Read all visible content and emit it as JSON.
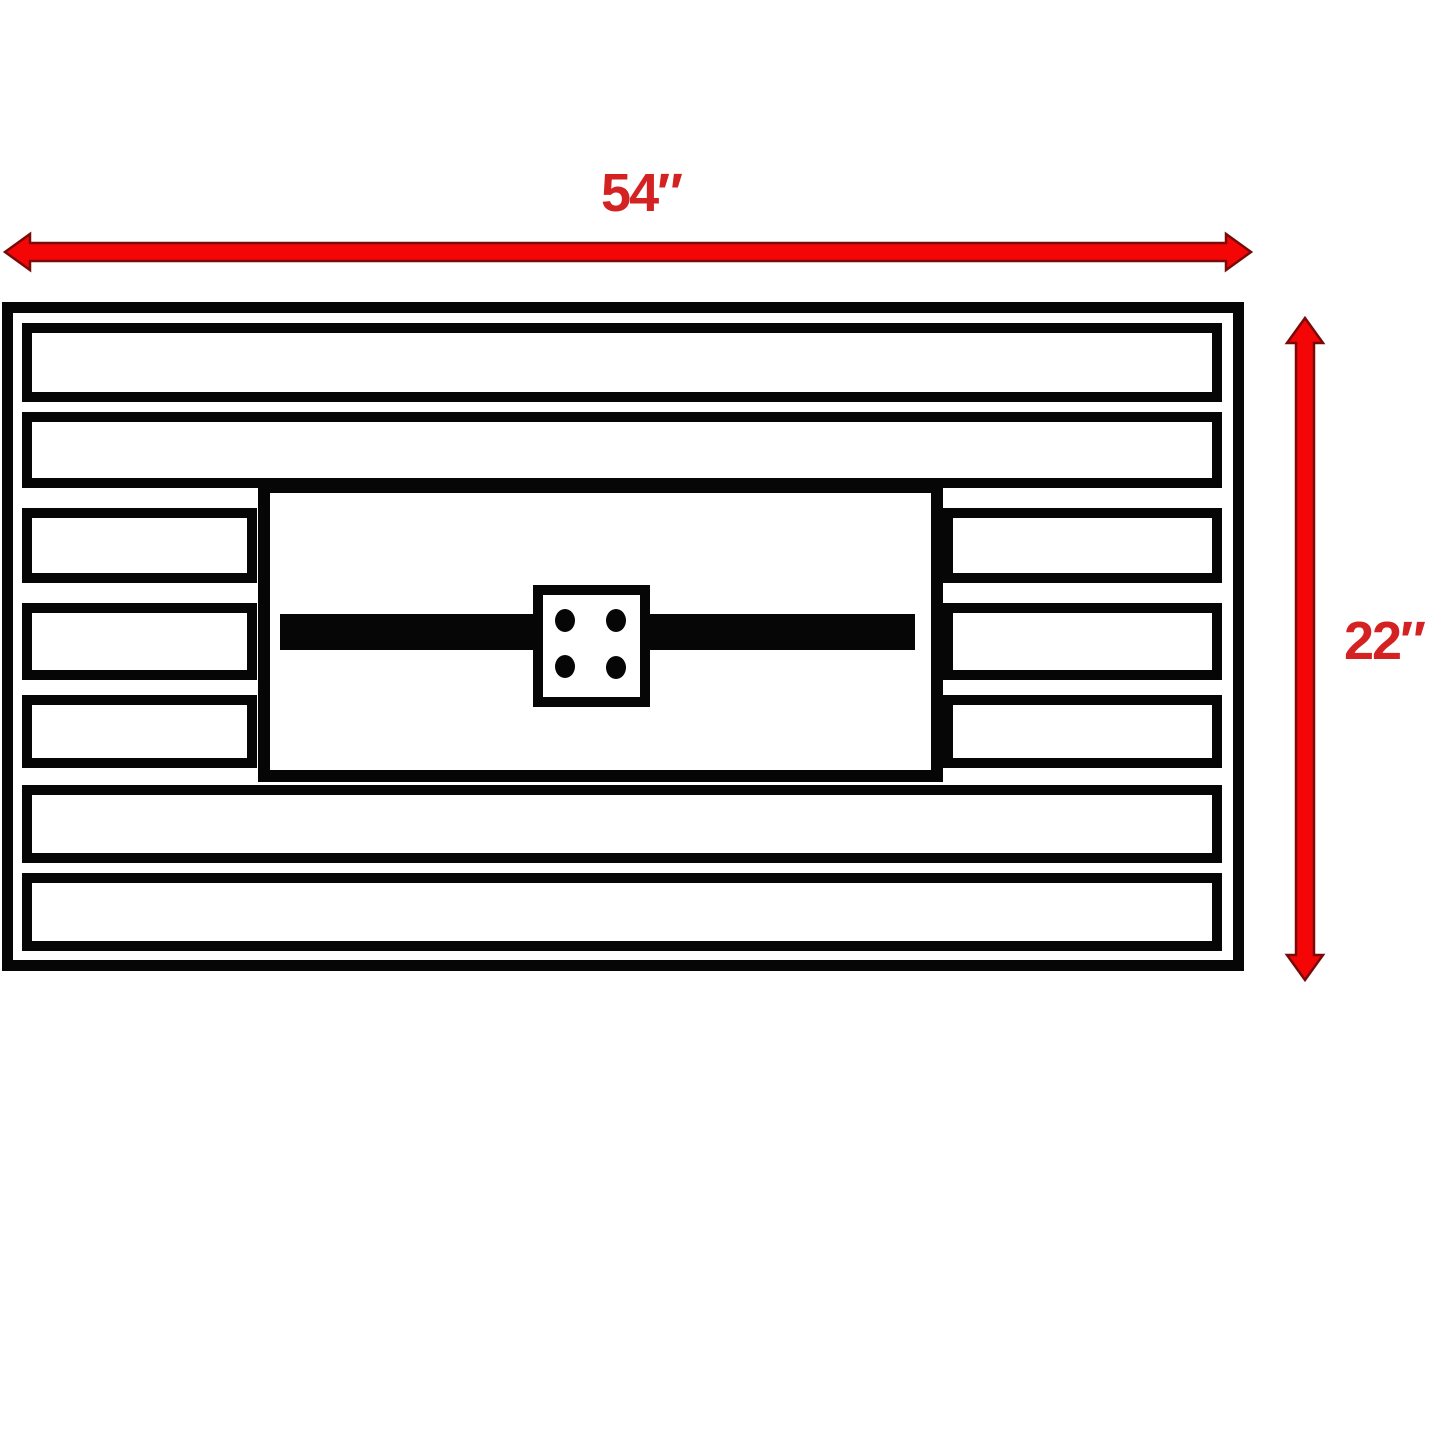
{
  "labels": {
    "width": "54″",
    "height": "22″"
  },
  "colors": {
    "background": "#ffffff",
    "line_black": "#060606",
    "arrow_red": "#f40606",
    "arrow_outline": "#7a0a0a",
    "label_red": "#d42121"
  },
  "structure": {
    "full_width_planks": 4,
    "short_plank_rows": 3,
    "burner_holes": 4
  }
}
